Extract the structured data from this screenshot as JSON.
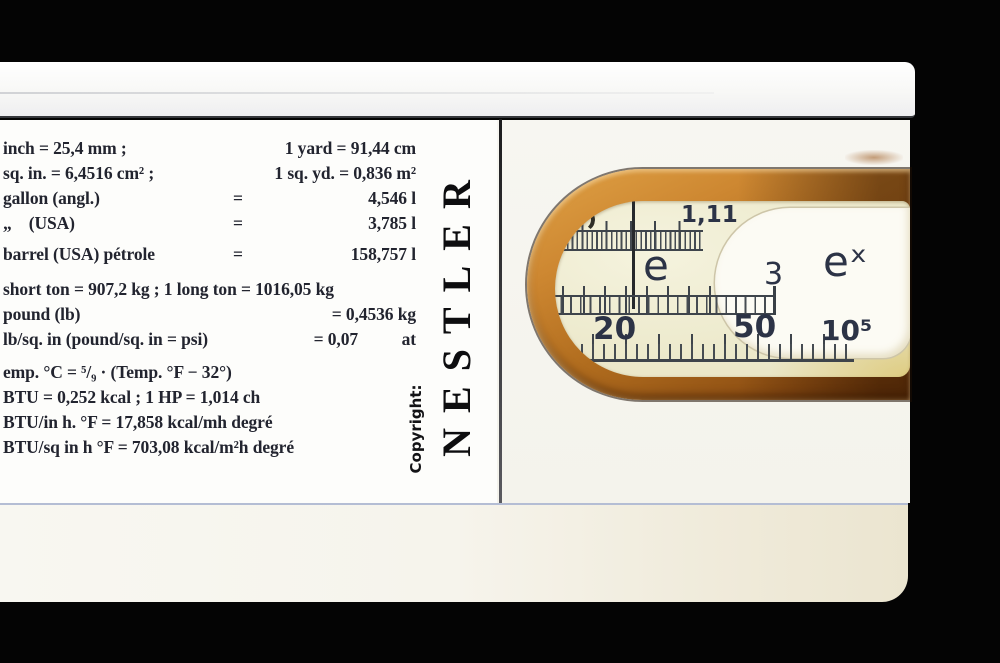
{
  "scene": {
    "description": "Photograph of the end of a Nestler slide rule on black background, with a printed conversion table and a rounded cut-out window revealing log-log scales",
    "colors": {
      "background": "#040404",
      "body_white": "#f7f6f1",
      "label_panel": "#fdfdfb",
      "table_ink": "#22242f",
      "frame_wood": "#b06c1e",
      "window_cream": "#edeacd",
      "scale_ink": "#2c3346",
      "tongue_white": "#fcfbf4"
    }
  },
  "brand": {
    "name": "NESTLER",
    "copyright_label": "Copyright:"
  },
  "conversion_table": {
    "rows": [
      {
        "left": "inch = 25,4 mm ;",
        "eq": "",
        "value": "1 yard = 91,44 cm",
        "unit": ""
      },
      {
        "left": "sq. in. = 6,4516 cm² ;",
        "eq": "",
        "value": "1 sq. yd. = 0,836 m²",
        "unit": ""
      },
      {
        "left": "gallon (angl.)",
        "eq": "=",
        "value": "4,546 l",
        "unit": ""
      },
      {
        "left": "„    (USA)",
        "eq": "=",
        "value": "3,785 l",
        "unit": ""
      },
      {
        "left": "barrel (USA) pétrole",
        "eq": "=",
        "value": "158,757 l",
        "unit": ""
      },
      {
        "left": "short ton = 907,2 kg ; 1 long ton = 1016,05 kg",
        "eq": "",
        "value": "",
        "unit": ""
      },
      {
        "left": "pound (lb)",
        "eq": "",
        "value": "= 0,4536 kg",
        "unit": ""
      },
      {
        "left": "lb/sq. in (pound/sq. in = psi)",
        "eq": "",
        "value": "= 0,07",
        "unit": "at"
      },
      {
        "left": "emp. °C = ⁵/₉ · (Temp. °F − 32°)",
        "eq": "",
        "value": "",
        "unit": ""
      },
      {
        "left": "BTU = 0,252 kcal ; 1 HP = 1,014 ch",
        "eq": "",
        "value": "",
        "unit": ""
      },
      {
        "left": "BTU/in h. °F = 17,858 kcal/mh degré",
        "eq": "",
        "value": "",
        "unit": ""
      },
      {
        "left": "BTU/sq in h °F = 703,08 kcal/m²h degré",
        "eq": "",
        "value": "",
        "unit": ""
      }
    ]
  },
  "window": {
    "labels": {
      "partial": "ɔ",
      "top": "1,11",
      "e": "e",
      "three": "3",
      "ex": "eˣ",
      "b20": "20",
      "b50": "50",
      "b10e5": "10⁵"
    }
  }
}
